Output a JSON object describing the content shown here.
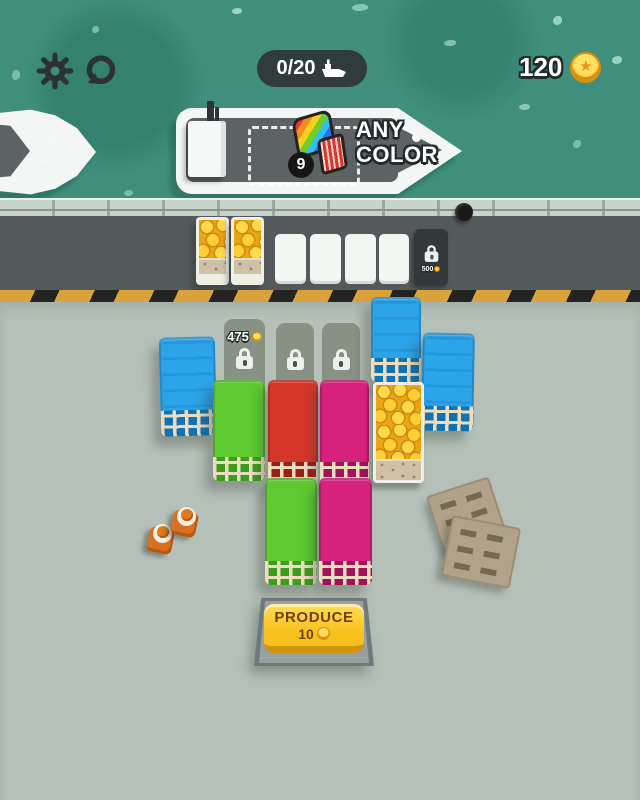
{
  "hud": {
    "ship_counter": {
      "value": "0/20",
      "icon": "ship-icon"
    },
    "coin_counter": {
      "value": "120",
      "icon": "coin-icon"
    },
    "settings_icon": "gear-icon",
    "restart_icon": "restart-icon"
  },
  "ship_order": {
    "count": "9",
    "line1": "ANY",
    "line2": "COLOR",
    "icon": "rainbow-container-icon"
  },
  "dock": {
    "coin_pallet_count": 2,
    "empty_slot_count": 4,
    "locked_slot": {
      "price": "500",
      "icon": "lock-icon"
    }
  },
  "yard": {
    "locked_slots": [
      {
        "price": "475",
        "icon": "lock-icon"
      },
      {
        "icon": "lock-icon"
      },
      {
        "icon": "lock-icon"
      }
    ],
    "containers": [
      {
        "color": "blue",
        "position": "left"
      },
      {
        "color": "green",
        "position": "row1-col1"
      },
      {
        "color": "red",
        "position": "row1-col2"
      },
      {
        "color": "magenta",
        "position": "row1-col3"
      },
      {
        "color": "gold-coins",
        "position": "row1-col4"
      },
      {
        "color": "blue",
        "position": "top-right"
      },
      {
        "color": "blue",
        "position": "right"
      },
      {
        "color": "green",
        "position": "row2-col2"
      },
      {
        "color": "magenta",
        "position": "row2-col3"
      }
    ],
    "props": {
      "traffic_cones": 2,
      "wooden_pallets": 2
    }
  },
  "produce_button": {
    "label": "PRODUCE",
    "cost": "10",
    "icon": "coin-icon"
  },
  "icons": {
    "coin_star": "★"
  },
  "colors": {
    "water": "#3f8f7c",
    "dock": "#54595b",
    "yard": "#b5c0b8",
    "hazard_yellow": "#d9a23a",
    "container_blue": "#2aa3e9",
    "container_green": "#5ec931",
    "container_red": "#d6352a",
    "container_magenta": "#d6217d",
    "coin_gold": "#f6bc1c",
    "button_yellow": "#f8c01c"
  }
}
